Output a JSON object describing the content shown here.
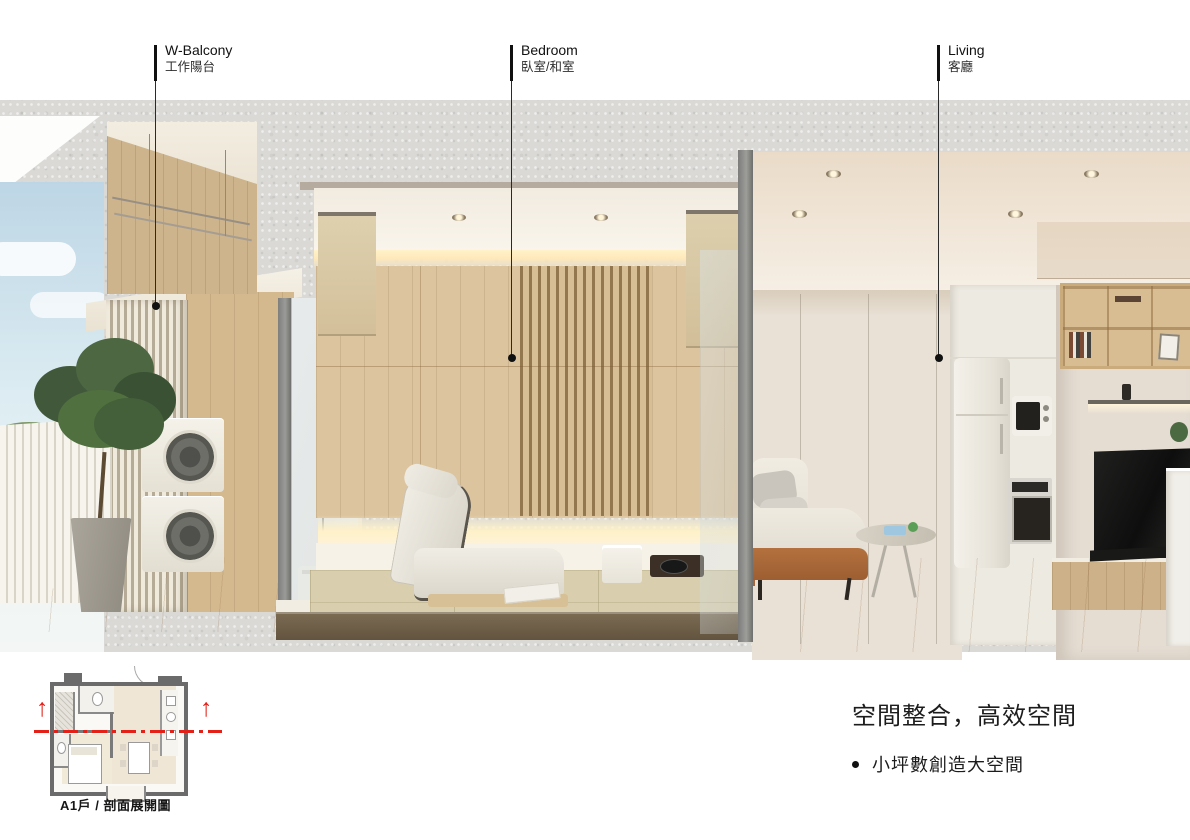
{
  "callouts": [
    {
      "en": "W-Balcony",
      "zh": "工作陽台"
    },
    {
      "en": "Bedroom",
      "zh": "臥室/和室"
    },
    {
      "en": "Living",
      "zh": "客廳"
    }
  ],
  "floorplan": {
    "caption": "A1戶 / 剖面展開圖"
  },
  "summary": {
    "title": "空間整合，高效空間",
    "bullets": [
      "小坪數創造大空間"
    ]
  },
  "colors": {
    "accent_red": "#e32119",
    "concrete": "#dad9d6",
    "wood": "#dcc49e",
    "callout_ink": "#111111"
  }
}
